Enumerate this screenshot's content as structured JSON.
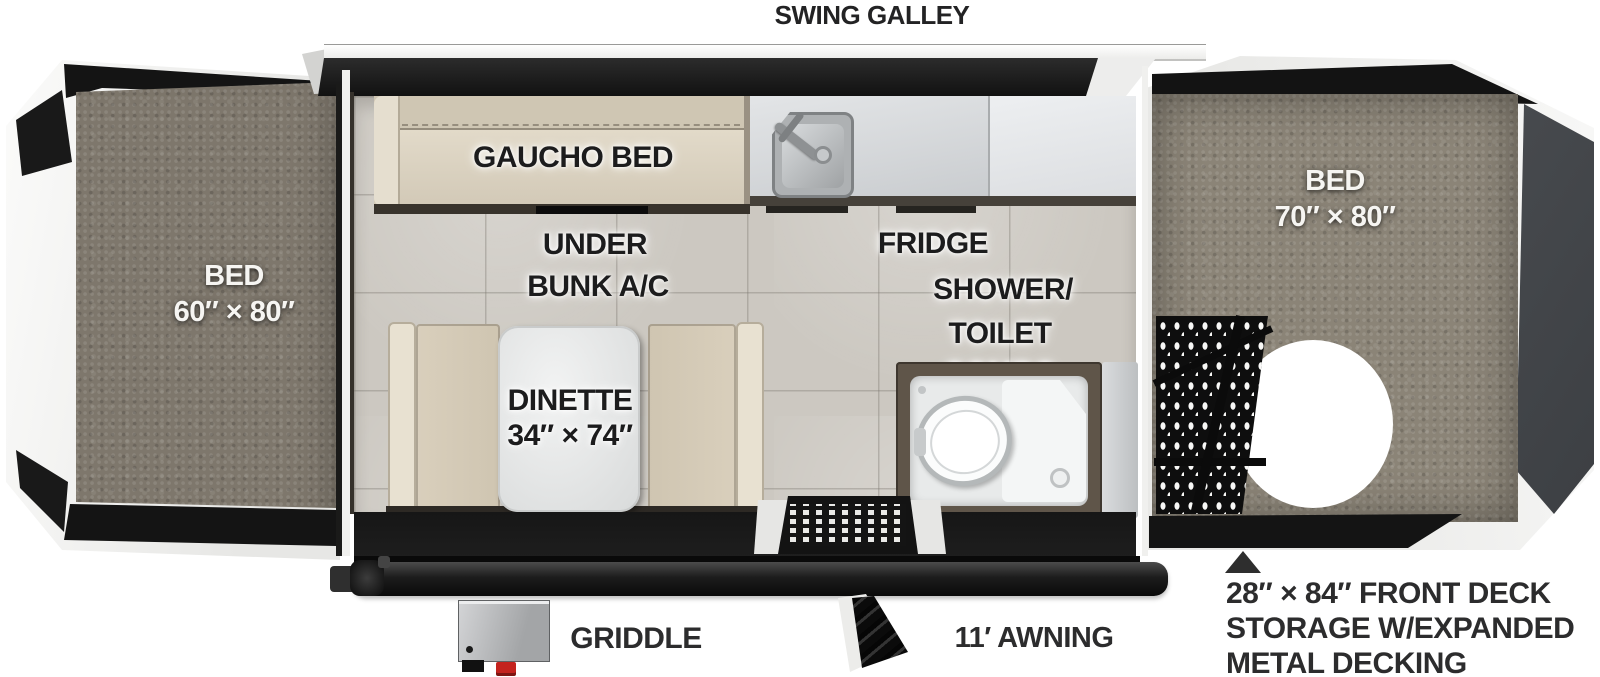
{
  "title": "SWING GALLEY",
  "colors": {
    "bed_fabric_left": "#7e776c",
    "bed_fabric_right": "#8b8477",
    "cushion_tan": "#d8cfbd",
    "counter_gray": "#d9dbdd",
    "floor_tile": "#ccc8c1",
    "frame_black": "#181818",
    "trim_white": "#f4f4f3",
    "griddle_knob_red": "#c4231e",
    "annotation_text": "#2c2c2d"
  },
  "labels": {
    "bed_left_name": "BED",
    "bed_left_size": "60″ × 80″",
    "bed_right_name": "BED",
    "bed_right_size": "70″ × 80″",
    "gaucho_bed": "GAUCHO BED",
    "under_bunk_line1": "UNDER",
    "under_bunk_line2": "BUNK A/C",
    "fridge": "FRIDGE",
    "shower_line1": "SHOWER/",
    "shower_line2": "TOILET",
    "shower_line3": "COMBO",
    "dinette_name": "DINETTE",
    "dinette_size": "34″ × 74″",
    "griddle": "GRIDDLE",
    "awning": "11′ AWNING",
    "deck_line1": "28″ × 84″ FRONT DECK",
    "deck_line2": "STORAGE W/EXPANDED",
    "deck_line3": "METAL DECKING"
  }
}
